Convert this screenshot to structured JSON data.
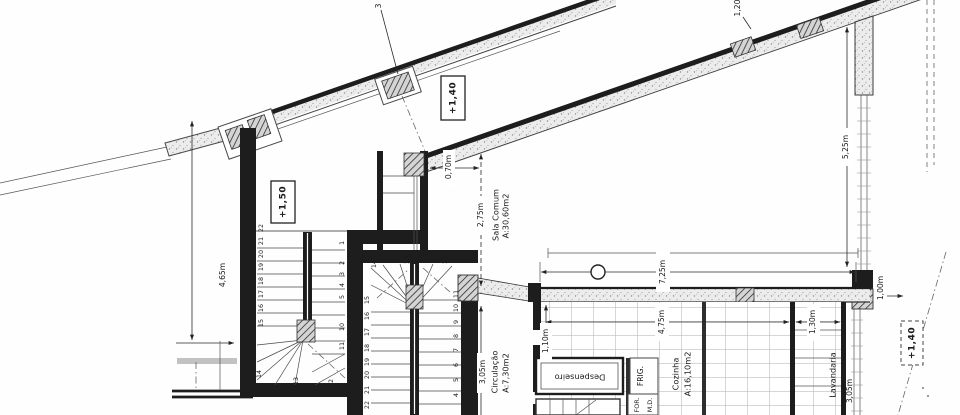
{
  "axis": {
    "grid3": "3"
  },
  "levels": {
    "terrace_upper": "+1,40",
    "stair_landing": "+1,50",
    "terrace_lower": "+1,40"
  },
  "rooms": {
    "sala": {
      "name": "Sala Comum",
      "area": "A:30,60m2"
    },
    "circulacao": {
      "name": "Circulação",
      "area": "A:7,30m2",
      "width": "3,05m"
    },
    "cozinha": {
      "name": "Cozinha",
      "area": "A:16,10m2"
    },
    "despensa": {
      "name": "Despenseiro"
    },
    "lavandaria": {
      "name": "Lavandaria",
      "depth": "3,05m"
    }
  },
  "appliances": {
    "fridge": "FRIG.",
    "oven": "FOR.",
    "dishwasher": "M.D."
  },
  "dimensions": {
    "wall_opening": "1,20",
    "right_wall": "5,25m",
    "niche_width": "0,70m",
    "sala_height": "2,75m",
    "left_wall": "4,65m",
    "sala_width": "7,25m",
    "kitchen_width": "4,75m",
    "kitchen_right": "1,30m",
    "pantry_offset": "1,10m",
    "terrace_edge": "1,00m"
  },
  "stairs": {
    "stair1": {
      "left": [
        "22",
        "21",
        "20",
        "19",
        "18",
        "17",
        "16",
        "15"
      ],
      "right": [
        "1",
        "2",
        "3",
        "4",
        "5",
        "10",
        "11"
      ],
      "winders": [
        "14",
        "13",
        "12"
      ]
    },
    "stair2": {
      "winders": [
        "14",
        "13",
        "12"
      ],
      "left": [
        "15",
        "16",
        "17",
        "18",
        "19",
        "20",
        "21",
        "22"
      ],
      "right": [
        "11",
        "10",
        "9",
        "8",
        "7",
        "6",
        "5",
        "4"
      ]
    }
  }
}
